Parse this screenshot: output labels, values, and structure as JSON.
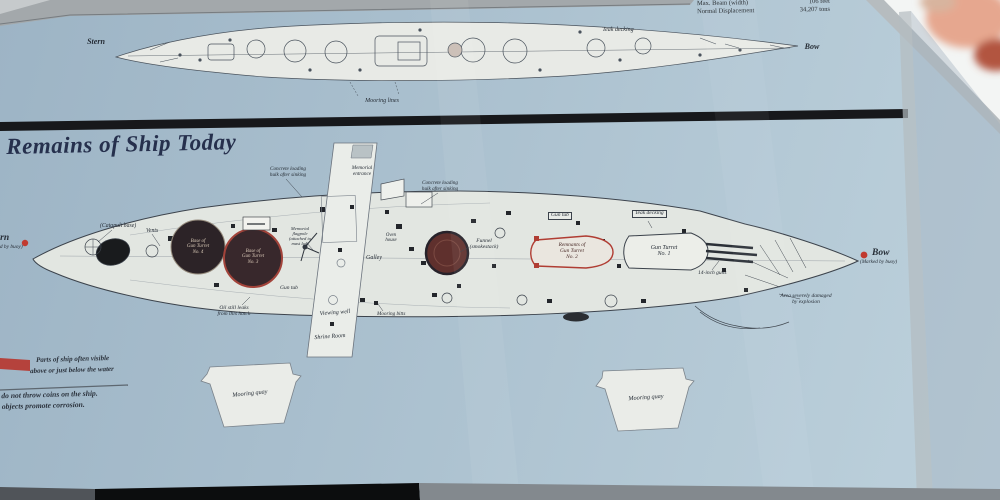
{
  "heading": {
    "title": "Remains of Ship Today"
  },
  "specs": [
    {
      "label": "Max. Beam (width)",
      "value": "106 feet"
    },
    {
      "label": "Normal Displacement",
      "value": "34,207 tons"
    }
  ],
  "legend": {
    "swatch_color": "#b5423c",
    "line1": "Parts of ship often visible",
    "line2": "above or just below the water",
    "note1": "e do not throw coins on the ship.",
    "note2": "m objects promote corrosion."
  },
  "colors": {
    "sign_background": "#acc2d0",
    "divider_band": "#17181b",
    "accent_red": "#b5423c",
    "ink": "#2a313b",
    "heading": "#26304d"
  },
  "labels": [
    {
      "name": "label-stern-top",
      "text": "Stern",
      "x": 96,
      "y": 38,
      "size": 8,
      "bold": true,
      "align": "center"
    },
    {
      "name": "label-bow-top",
      "text": "Bow",
      "x": 812,
      "y": 43,
      "size": 8,
      "bold": true,
      "align": "center"
    },
    {
      "name": "label-mooring-lines",
      "text": "Mooring lines",
      "x": 382,
      "y": 98,
      "size": 6,
      "align": "center"
    },
    {
      "name": "label-teak-decking-top",
      "text": "Teak decking",
      "x": 618,
      "y": 27,
      "size": 6,
      "align": "center"
    },
    {
      "name": "label-stern-wreck",
      "text": "Stern",
      "x": -12,
      "y": 233,
      "size": 9.5,
      "bold": true
    },
    {
      "name": "label-stern-buoy",
      "text": "(Marked by buoy)",
      "x": -16,
      "y": 245,
      "size": 5.4
    },
    {
      "name": "label-catapult-base",
      "text": "(Catapult base)",
      "x": 100,
      "y": 223,
      "size": 5.8
    },
    {
      "name": "label-vents",
      "text": "Vents",
      "x": 146,
      "y": 228,
      "size": 5.8
    },
    {
      "name": "label-turret4",
      "text": "Base of\nGun Turret\nNo. 4",
      "x": 198,
      "y": 239,
      "size": 5,
      "align": "center",
      "color": "#d8c9b6"
    },
    {
      "name": "label-turret3",
      "text": "Base of\nGun Turret\nNo. 3",
      "x": 253,
      "y": 249,
      "size": 5,
      "align": "center",
      "color": "#d8c7b6"
    },
    {
      "name": "label-memorial-entrance",
      "text": "Memorial\nentrance",
      "x": 362,
      "y": 166,
      "size": 5.2,
      "align": "center"
    },
    {
      "name": "label-hulk-left",
      "text": "Concrete loading\nhulk after sinking",
      "x": 288,
      "y": 167,
      "size": 5.2,
      "align": "center"
    },
    {
      "name": "label-hulk-right",
      "text": "Concrete loading\nhulk after sinking",
      "x": 440,
      "y": 181,
      "size": 5.2,
      "align": "center"
    },
    {
      "name": "label-flagpole",
      "text": "Memorial\nflagpole\n(attached to\nmast leg)",
      "x": 300,
      "y": 227,
      "size": 4.6,
      "align": "center"
    },
    {
      "name": "label-oven-house",
      "text": "Oven\nhouse",
      "x": 391,
      "y": 233,
      "size": 4.8,
      "align": "center"
    },
    {
      "name": "label-galley",
      "text": "Galley",
      "x": 366,
      "y": 255,
      "size": 6
    },
    {
      "name": "label-gun-tub-left",
      "text": "Gun tub",
      "x": 280,
      "y": 286,
      "size": 5.5
    },
    {
      "name": "label-funnel",
      "text": "Funnel\n(smokestack)",
      "x": 484,
      "y": 239,
      "size": 5.5,
      "align": "center"
    },
    {
      "name": "label-gun-tub-right",
      "text": "Gun tub",
      "x": 548,
      "y": 212,
      "size": 5.5,
      "box": true
    },
    {
      "name": "label-teak-decking-wreck",
      "text": "Teak decking",
      "x": 632,
      "y": 210,
      "size": 5.5,
      "box": true
    },
    {
      "name": "label-turret2",
      "text": "Remnants of\nGun Turret\nNo. 2",
      "x": 572,
      "y": 243,
      "size": 5.4,
      "align": "center",
      "color": "#4a2b28"
    },
    {
      "name": "label-turret1",
      "text": "Gun Turret\nNo. 1",
      "x": 664,
      "y": 245,
      "size": 6,
      "align": "center"
    },
    {
      "name": "label-14-inch-guns",
      "text": "14-inch guns",
      "x": 698,
      "y": 271,
      "size": 5.5
    },
    {
      "name": "label-damage",
      "text": "Area severely damaged\nby explosion",
      "x": 806,
      "y": 294,
      "size": 5.5,
      "align": "center"
    },
    {
      "name": "label-bow-wreck",
      "text": "Bow",
      "x": 872,
      "y": 248,
      "size": 9.5,
      "bold": true
    },
    {
      "name": "label-bow-buoy",
      "text": "(Marked by buoy)",
      "x": 860,
      "y": 260,
      "size": 5.2
    },
    {
      "name": "label-oil-leak",
      "text": "Oil still leaks\nfrom this hatch",
      "x": 234,
      "y": 306,
      "size": 5.5,
      "align": "center"
    },
    {
      "name": "label-viewing-well",
      "text": "Viewing well",
      "x": 335,
      "y": 310,
      "size": 6,
      "align": "center",
      "rotate": -4
    },
    {
      "name": "label-shrine-room",
      "text": "Shrine Room",
      "x": 330,
      "y": 334,
      "size": 6,
      "align": "center",
      "rotate": -4
    },
    {
      "name": "label-mooring-bitts",
      "text": "Mooring bitts",
      "x": 377,
      "y": 312,
      "size": 5.2
    },
    {
      "name": "label-quay-left",
      "text": "Mooring quay",
      "x": 250,
      "y": 391,
      "size": 6.2,
      "align": "center",
      "rotate": -6
    },
    {
      "name": "label-quay-right",
      "text": "Mooring quay",
      "x": 646,
      "y": 395,
      "size": 6.2,
      "align": "center",
      "rotate": -4
    }
  ]
}
